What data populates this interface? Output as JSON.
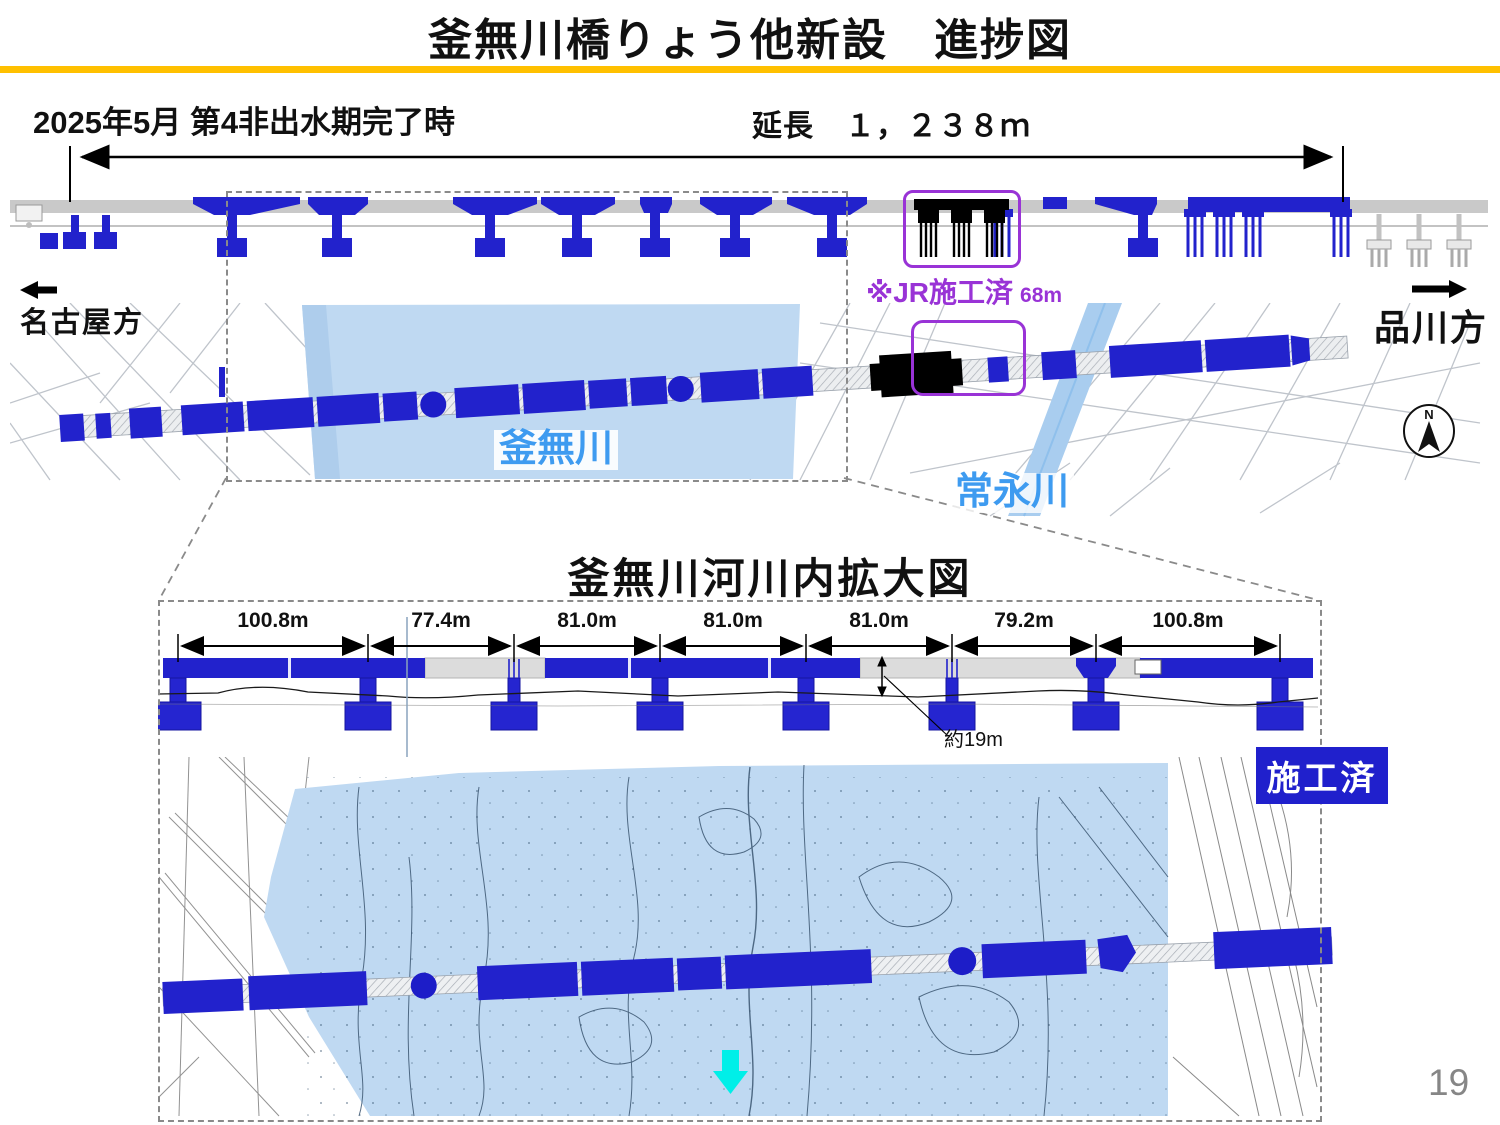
{
  "slide": {
    "title": "釜無川橋りょう他新設　進捗図",
    "page_number": "19"
  },
  "overview": {
    "status_label": "2025年5月 第4非出水期完了時",
    "extension_label": "延長　１，２３８ｍ",
    "direction_left": "名古屋方",
    "direction_right": "品川方",
    "jr_completed_note": "※JR施工済",
    "jr_completed_length": "68m",
    "river_kamanashi": "釜無川",
    "river_tsunenaga": "常永川",
    "compass_north": "N"
  },
  "enlarged": {
    "title": "釜無川河川内拡大図",
    "spans": [
      "100.8m",
      "77.4m",
      "81.0m",
      "81.0m",
      "81.0m",
      "79.2m",
      "100.8m"
    ],
    "pier_height_note": "約19m",
    "completed_label": "施工済"
  },
  "colors": {
    "completed_blue": "#2222CC",
    "river_fill": "#BFD9F2",
    "stream_fill": "#A9CDEF",
    "jr_purple": "#9933D6",
    "divider_yellow": "#FFC000",
    "flow_arrow_cyan": "#00EFE8",
    "river_label_blue": "#3E9BF0",
    "unbuilt_gray": "#DCDCDC"
  }
}
